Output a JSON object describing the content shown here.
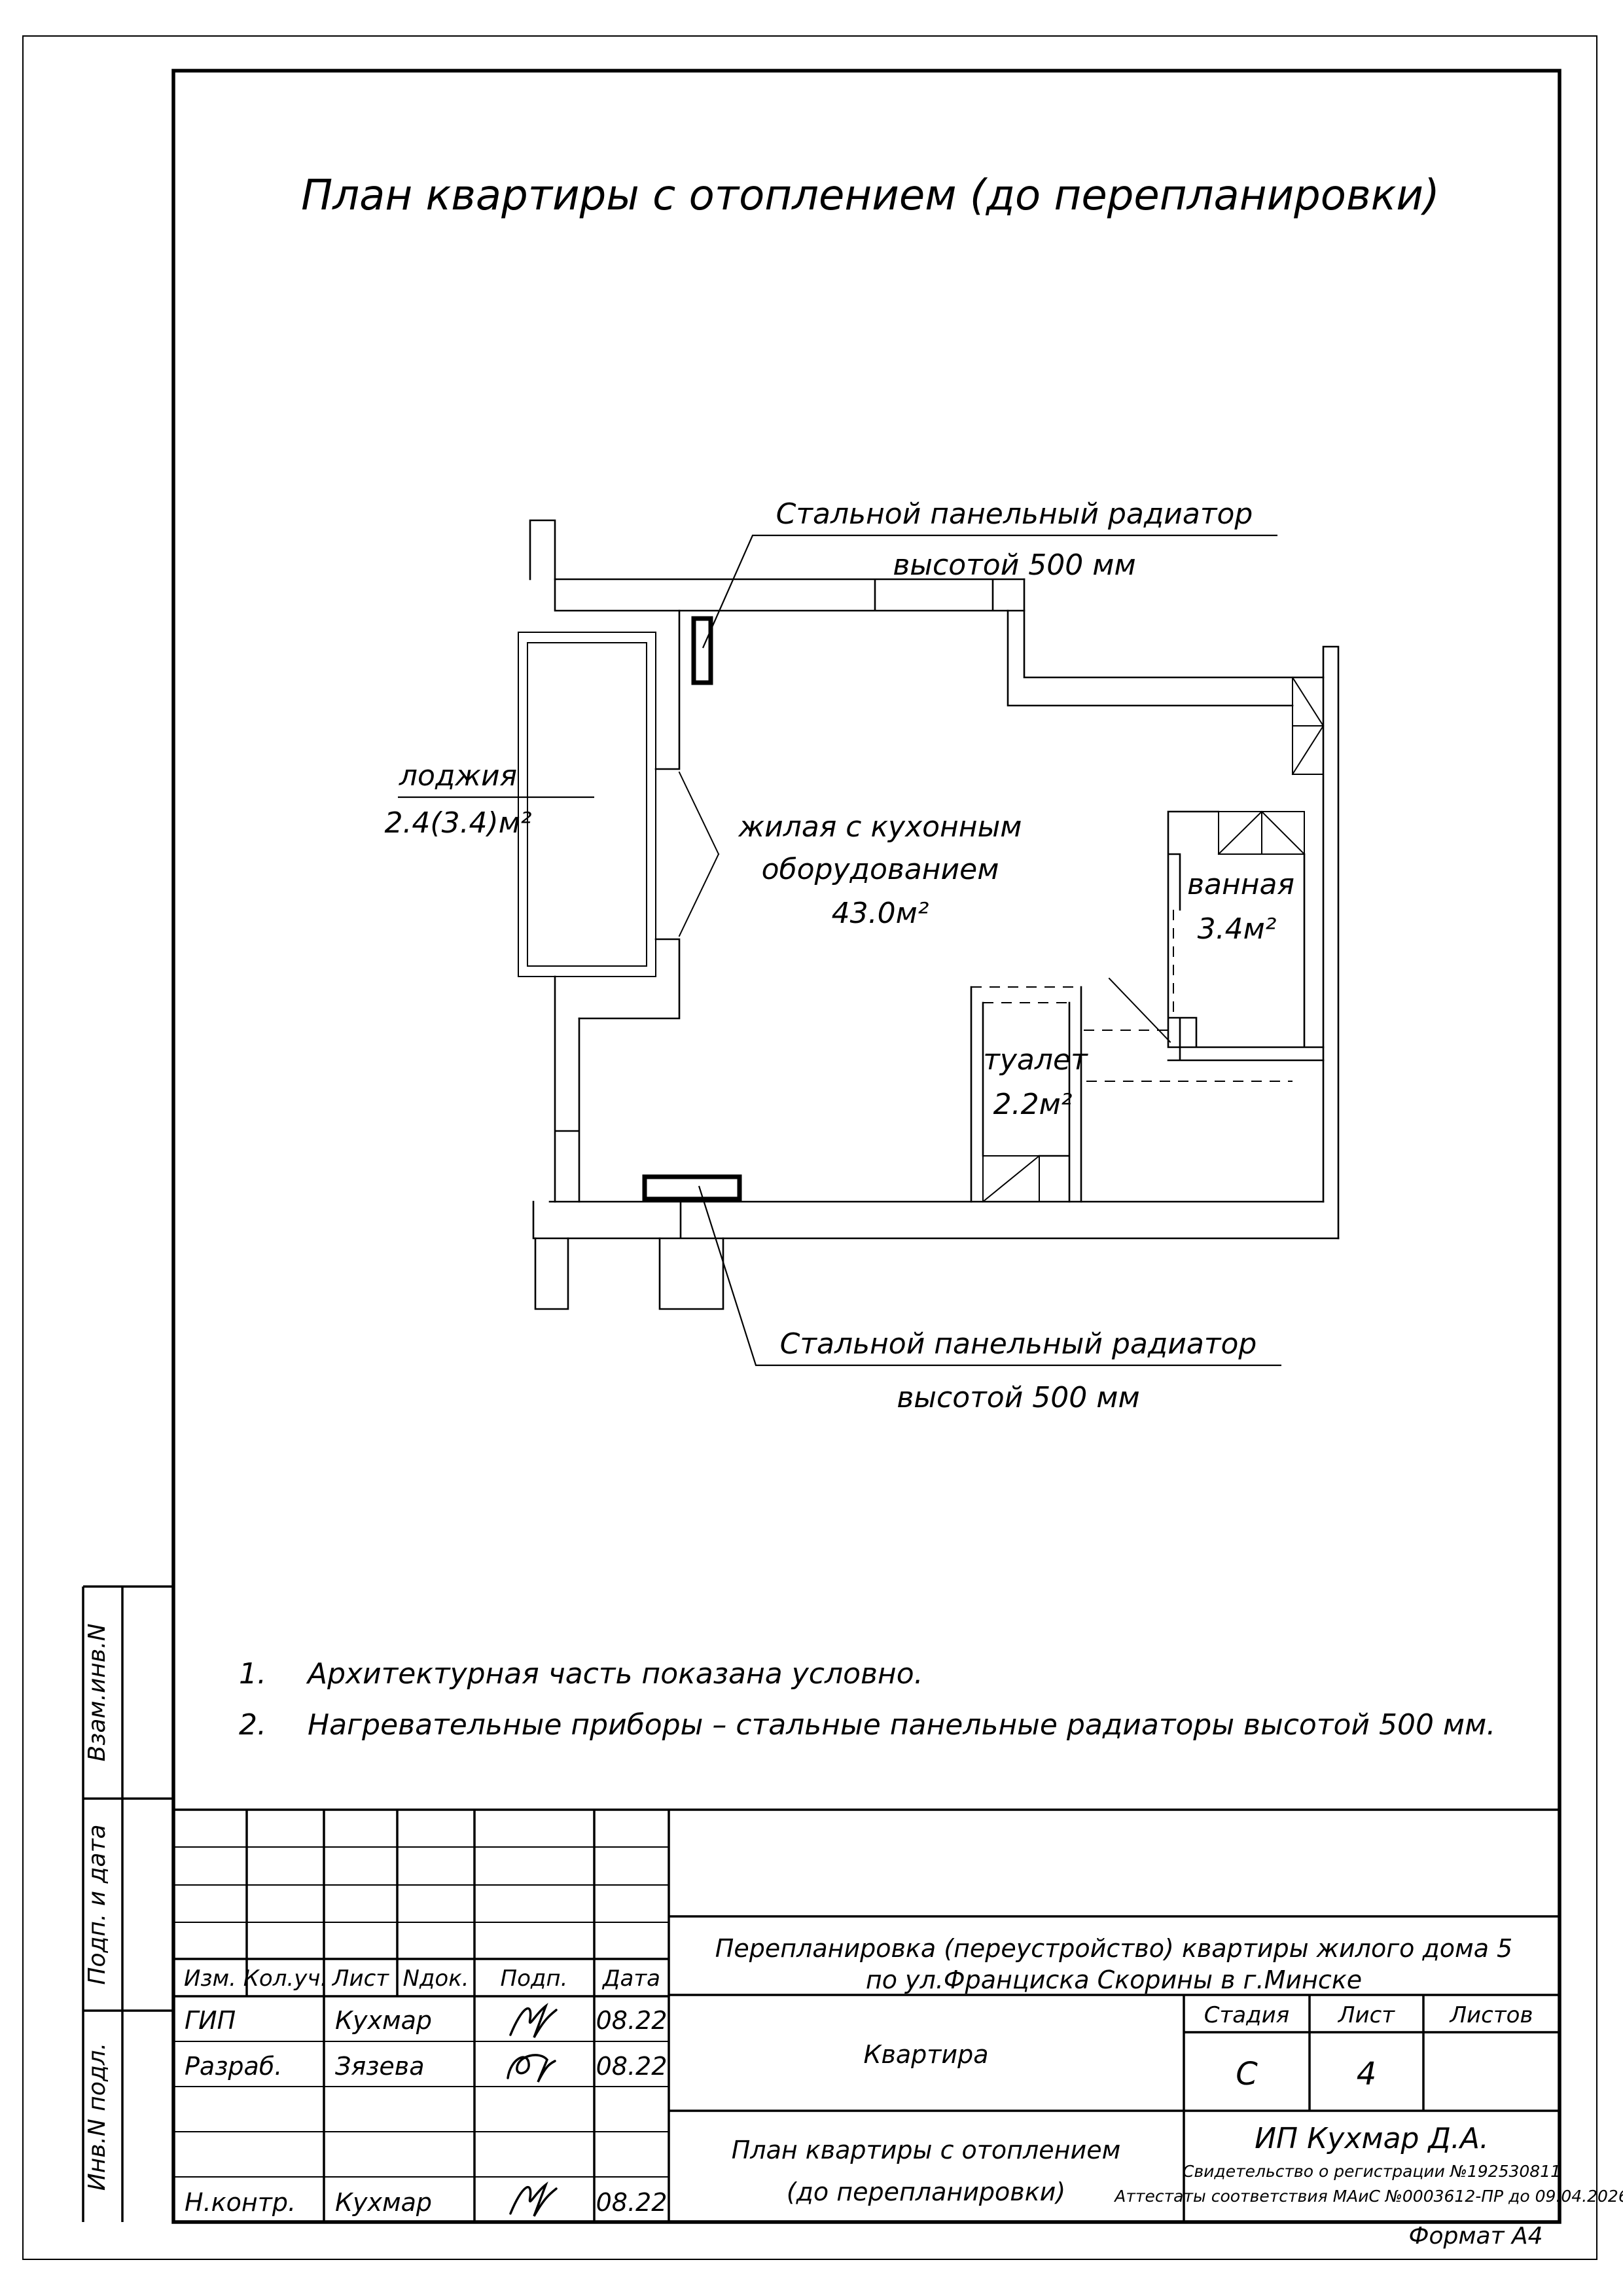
{
  "title": "План квартиры с отоплением (до перепланировки)",
  "plan": {
    "labels": {
      "rad_top1": "Стальной панельный радиатор",
      "rad_top2": "высотой 500 мм",
      "rad_bot1": "Стальной панельный радиатор",
      "rad_bot2": "высотой 500 мм",
      "loggia_name": "лоджия",
      "loggia_area": "2.4(3.4)м²",
      "living1": "жилая с кухонным",
      "living2": "оборудованием",
      "living_area": "43.0м²",
      "bath_name": "ванная",
      "bath_area": "3.4м²",
      "wc_name": "туалет",
      "wc_area": "2.2м²"
    }
  },
  "notes": [
    {
      "num": "1.",
      "text": "Архитектурная часть показана условно."
    },
    {
      "num": "2.",
      "text": "Нагревательные приборы – стальные панельные радиаторы высотой 500 мм."
    }
  ],
  "sidebar": {
    "labels": [
      "Взам.инв.N",
      "Подп. и дата",
      "Инв.N подл."
    ]
  },
  "stamp": {
    "header": [
      "Изм.",
      "Кол.уч.",
      "Лист",
      "Nдок.",
      "Подп.",
      "Дата"
    ],
    "rows": [
      {
        "role": "ГИП",
        "name": "Кухмар",
        "date": "08.22"
      },
      {
        "role": "Разраб.",
        "name": "Зязева",
        "date": "08.22"
      },
      {
        "role": "",
        "name": "",
        "date": ""
      },
      {
        "role": "",
        "name": "",
        "date": ""
      },
      {
        "role": "Н.контр.",
        "name": "Кухмар",
        "date": "08.22"
      }
    ],
    "project_line1": "Перепланировка (переустройство) квартиры жилого дома 5",
    "project_line2": "по ул.Франциска Скорины в г.Минске",
    "object_name": "Квартира",
    "stage_label": "Стадия",
    "sheet_label": "Лист",
    "sheets_label": "Листов",
    "stage_value": "С",
    "sheet_value": "4",
    "sheets_value": "",
    "sheet_title_line1": "План квартиры с отоплением",
    "sheet_title_line2": "(до перепланировки)",
    "org_name": "ИП Кухмар Д.А.",
    "org_cert1": "Свидетельство о регистрации №192530811",
    "org_cert2": "Аттестаты соответствия МАиС №0003612-ПР до 09.04.2026",
    "format_note": "Формат А4"
  }
}
